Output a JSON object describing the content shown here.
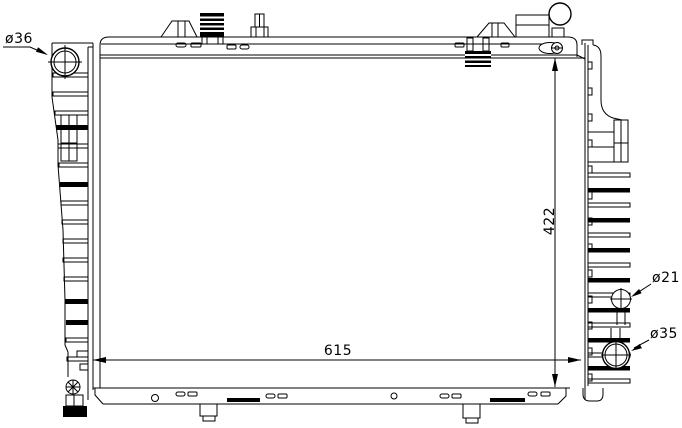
{
  "diagram": {
    "type": "technical-line-drawing",
    "subject": "automotive radiator, front view with mounting tanks and ports",
    "colors": {
      "background": "#ffffff",
      "line": "#000000"
    },
    "labels": {
      "inlet_diameter": "ø36",
      "core_width": "615",
      "core_height": "422",
      "upper_port_diameter": "ø21",
      "outlet_diameter": "ø35"
    }
  }
}
